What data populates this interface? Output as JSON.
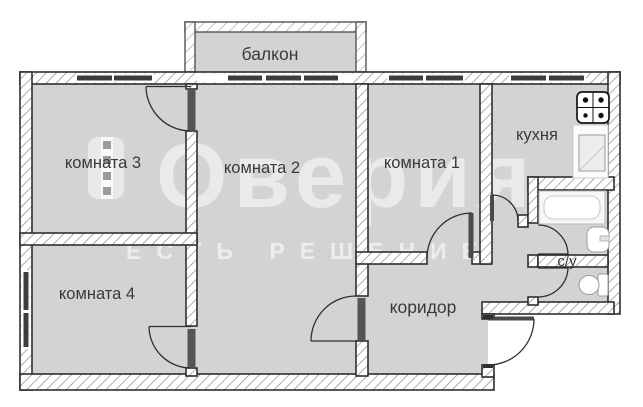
{
  "floorplan": {
    "type": "apartment-floor-plan",
    "labels": {
      "balcony": "балкон",
      "room3": "комната 3",
      "room2": "комната 2",
      "room1": "комната 1",
      "kitchen": "кухня",
      "room4": "комната 4",
      "corridor": "коридор",
      "bathroom": "с/у"
    },
    "watermark": {
      "brand": "Оверия",
      "tagline": "ЕСТЬ РЕШЕНИЕ"
    },
    "icons": [
      "stove-icon",
      "kitchen-sink-icon",
      "bathtub-icon",
      "bath-sink-icon",
      "toilet-icon"
    ],
    "colors": {
      "room_fill": "#d3d3d3",
      "wall_line": "#2f2f2f",
      "hatch_line": "#8a8a8a",
      "window_bar": "#3d3d3d",
      "label_text": "#3a3a3a",
      "watermark": "rgba(255,255,255,0.55)",
      "outside": "#ffffff"
    }
  }
}
